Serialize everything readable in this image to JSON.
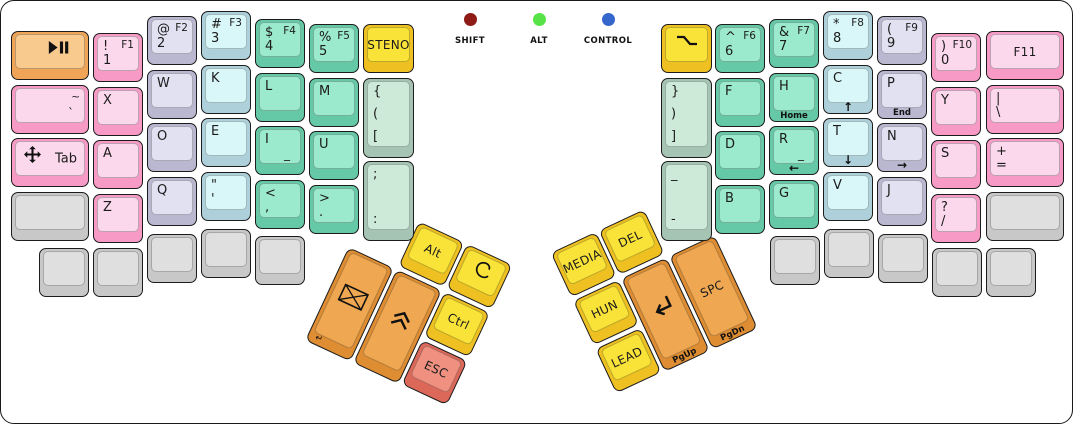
{
  "indicators": [
    {
      "id": "shift",
      "label": "SHIFT",
      "color": "#8e1b15"
    },
    {
      "id": "alt",
      "label": "ALT",
      "color": "#57e348"
    },
    {
      "id": "control",
      "label": "CONTROL",
      "color": "#3566cc"
    }
  ],
  "palette": {
    "orangeLight": {
      "side": "#f0a458",
      "top": "#f9ca8e"
    },
    "orange": {
      "side": "#de8d33",
      "top": "#efa851"
    },
    "pink": {
      "side": "#f79ac5",
      "top": "#fbd8ec"
    },
    "lavender": {
      "side": "#bab8d0",
      "top": "#e2e1f2"
    },
    "blue": {
      "side": "#aed0da",
      "top": "#d9f7f9"
    },
    "teal": {
      "side": "#65c8a6",
      "top": "#9ceacd"
    },
    "sage": {
      "side": "#a6c4b3",
      "top": "#cdead9"
    },
    "yellow": {
      "side": "#eec021",
      "top": "#fae339"
    },
    "red": {
      "side": "#dc685a",
      "top": "#ef9080"
    },
    "gray": {
      "side": "#c8c8c8",
      "top": "#dfdfdf"
    }
  },
  "keys": [
    {
      "id": "play-pause",
      "x": 10,
      "y": 30,
      "w": 78,
      "fam": "orangeLight",
      "icon": "play-pause",
      "iconPos": "right"
    },
    {
      "id": "grave",
      "x": 10,
      "y": 84,
      "w": 78,
      "fam": "pink",
      "legends": {
        "tr": "~",
        "br": "`"
      }
    },
    {
      "id": "tab",
      "x": 10,
      "y": 137,
      "w": 78,
      "fam": "pink",
      "icon": "move",
      "iconPos": "left",
      "legends": {
        "cr": "Tab"
      }
    },
    {
      "id": "blank-left-row4",
      "x": 10,
      "y": 191,
      "w": 78,
      "fam": "gray"
    },
    {
      "id": "1",
      "x": 92,
      "y": 32,
      "fam": "pink",
      "legends": {
        "tl": "!",
        "tr": "F1",
        "bl": "1"
      }
    },
    {
      "id": "x",
      "x": 92,
      "y": 86,
      "fam": "pink",
      "legends": {
        "tl": "X"
      }
    },
    {
      "id": "a",
      "x": 92,
      "y": 139,
      "fam": "pink",
      "legends": {
        "tl": "A"
      }
    },
    {
      "id": "z",
      "x": 92,
      "y": 193,
      "fam": "pink",
      "legends": {
        "tl": "Z"
      }
    },
    {
      "id": "2",
      "x": 146,
      "y": 15,
      "fam": "lavender",
      "legends": {
        "tl": "@",
        "tr": "F2",
        "bl": "2"
      }
    },
    {
      "id": "w",
      "x": 146,
      "y": 69,
      "fam": "lavender",
      "legends": {
        "tl": "W"
      }
    },
    {
      "id": "o",
      "x": 146,
      "y": 122,
      "fam": "lavender",
      "legends": {
        "tl": "O"
      }
    },
    {
      "id": "q",
      "x": 146,
      "y": 176,
      "fam": "lavender",
      "legends": {
        "tl": "Q"
      }
    },
    {
      "id": "3",
      "x": 200,
      "y": 10,
      "fam": "blue",
      "legends": {
        "tl": "#",
        "tr": "F3",
        "bl": "3"
      }
    },
    {
      "id": "k",
      "x": 200,
      "y": 64,
      "fam": "blue",
      "legends": {
        "tl": "K"
      }
    },
    {
      "id": "e",
      "x": 200,
      "y": 117,
      "fam": "blue",
      "legends": {
        "tl": "E"
      }
    },
    {
      "id": "quote",
      "x": 200,
      "y": 171,
      "fam": "blue",
      "legends": {
        "tl": "\"",
        "bl": "'"
      }
    },
    {
      "id": "4",
      "x": 254,
      "y": 18,
      "fam": "teal",
      "legends": {
        "tl": "$",
        "tr": "F4",
        "bl": "4"
      }
    },
    {
      "id": "l",
      "x": 254,
      "y": 72,
      "fam": "teal",
      "legends": {
        "tl": "L"
      }
    },
    {
      "id": "i",
      "x": 254,
      "y": 125,
      "fam": "teal",
      "legends": {
        "tl": "I",
        "br": "_"
      }
    },
    {
      "id": "comma",
      "x": 254,
      "y": 179,
      "fam": "teal",
      "legends": {
        "tl": "<",
        "bl": ","
      }
    },
    {
      "id": "5",
      "x": 308,
      "y": 23,
      "fam": "teal",
      "legends": {
        "tl": "%",
        "tr": "F5",
        "bl": "5"
      }
    },
    {
      "id": "m",
      "x": 308,
      "y": 77,
      "fam": "teal",
      "legends": {
        "tl": "M"
      }
    },
    {
      "id": "u",
      "x": 308,
      "y": 130,
      "fam": "teal",
      "legends": {
        "tl": "U"
      }
    },
    {
      "id": "period",
      "x": 308,
      "y": 184,
      "fam": "teal",
      "legends": {
        "tl": ">",
        "bl": "."
      }
    },
    {
      "id": "steno",
      "x": 362,
      "y": 23,
      "w": 51,
      "fam": "yellow",
      "legends": {
        "c": "STENO"
      }
    },
    {
      "id": "open-brackets",
      "x": 362,
      "y": 77,
      "w": 51,
      "h": 80,
      "fam": "sage",
      "legends": {
        "tl": "{",
        "cl": "(",
        "bl": "["
      }
    },
    {
      "id": "semicolon",
      "x": 362,
      "y": 160,
      "w": 51,
      "h": 80,
      "fam": "sage",
      "legends": {
        "tl": ";",
        "bl": ":"
      }
    },
    {
      "id": "blank-left-b1",
      "x": 38,
      "y": 247,
      "fam": "gray"
    },
    {
      "id": "blank-left-b2",
      "x": 92,
      "y": 247,
      "fam": "gray"
    },
    {
      "id": "blank-left-b3",
      "x": 146,
      "y": 233,
      "fam": "gray"
    },
    {
      "id": "blank-left-b4",
      "x": 200,
      "y": 228,
      "fam": "gray"
    },
    {
      "id": "blank-left-b5",
      "x": 254,
      "y": 235,
      "fam": "gray"
    },
    {
      "id": "layer",
      "x": 660,
      "y": 23,
      "w": 51,
      "fam": "yellow",
      "icon": "signal"
    },
    {
      "id": "close-brackets",
      "x": 660,
      "y": 77,
      "w": 51,
      "h": 80,
      "fam": "sage",
      "legends": {
        "tl": "}",
        "cl": ")",
        "bl": "]"
      }
    },
    {
      "id": "minus",
      "x": 660,
      "y": 160,
      "w": 51,
      "h": 80,
      "fam": "sage",
      "legends": {
        "tl": "_",
        "bl": "-"
      }
    },
    {
      "id": "6",
      "x": 714,
      "y": 23,
      "fam": "teal",
      "legends": {
        "tl": "^",
        "tr": "F6",
        "bl": "6"
      }
    },
    {
      "id": "f",
      "x": 714,
      "y": 77,
      "fam": "teal",
      "legends": {
        "tl": "F"
      }
    },
    {
      "id": "d",
      "x": 714,
      "y": 130,
      "fam": "teal",
      "legends": {
        "tl": "D"
      }
    },
    {
      "id": "b",
      "x": 714,
      "y": 184,
      "fam": "teal",
      "legends": {
        "tl": "B"
      }
    },
    {
      "id": "7",
      "x": 768,
      "y": 18,
      "fam": "teal",
      "legends": {
        "tl": "&",
        "tr": "F7",
        "bl": "7"
      }
    },
    {
      "id": "h",
      "x": 768,
      "y": 72,
      "fam": "teal",
      "legends": {
        "tl": "H"
      },
      "front": "Home"
    },
    {
      "id": "r",
      "x": 768,
      "y": 125,
      "fam": "teal",
      "legends": {
        "tl": "R",
        "br": "_"
      },
      "front": "←"
    },
    {
      "id": "g",
      "x": 768,
      "y": 179,
      "fam": "teal",
      "legends": {
        "tl": "G"
      }
    },
    {
      "id": "8",
      "x": 822,
      "y": 10,
      "fam": "blue",
      "legends": {
        "tl": "*",
        "tr": "F8",
        "bl": "8"
      }
    },
    {
      "id": "c",
      "x": 822,
      "y": 64,
      "fam": "blue",
      "legends": {
        "tl": "C"
      },
      "front": "↑"
    },
    {
      "id": "t",
      "x": 822,
      "y": 117,
      "fam": "blue",
      "legends": {
        "tl": "T"
      },
      "front": "↓"
    },
    {
      "id": "v",
      "x": 822,
      "y": 171,
      "fam": "blue",
      "legends": {
        "tl": "V"
      }
    },
    {
      "id": "9",
      "x": 876,
      "y": 15,
      "fam": "lavender",
      "legends": {
        "tl": "(",
        "tr": "F9",
        "bl": "9"
      }
    },
    {
      "id": "p",
      "x": 876,
      "y": 69,
      "fam": "lavender",
      "legends": {
        "tl": "P"
      },
      "front": "End"
    },
    {
      "id": "n",
      "x": 876,
      "y": 122,
      "fam": "lavender",
      "legends": {
        "tl": "N"
      },
      "front": "→"
    },
    {
      "id": "j",
      "x": 876,
      "y": 176,
      "fam": "lavender",
      "legends": {
        "tl": "J"
      }
    },
    {
      "id": "0",
      "x": 930,
      "y": 32,
      "fam": "pink",
      "legends": {
        "tl": ")",
        "tr": "F10",
        "bl": "0"
      }
    },
    {
      "id": "y",
      "x": 930,
      "y": 86,
      "fam": "pink",
      "legends": {
        "tl": "Y"
      }
    },
    {
      "id": "s",
      "x": 930,
      "y": 139,
      "fam": "pink",
      "legends": {
        "tl": "S"
      }
    },
    {
      "id": "slash",
      "x": 930,
      "y": 193,
      "fam": "pink",
      "legends": {
        "tl": "?",
        "bl": "/"
      }
    },
    {
      "id": "f11",
      "x": 985,
      "y": 30,
      "w": 78,
      "fam": "pink",
      "legends": {
        "c": "F11"
      }
    },
    {
      "id": "backslash",
      "x": 985,
      "y": 84,
      "w": 78,
      "fam": "pink",
      "legends": {
        "tl": "|",
        "bl": "\\"
      }
    },
    {
      "id": "equals",
      "x": 985,
      "y": 137,
      "w": 78,
      "fam": "pink",
      "legends": {
        "tl": "+",
        "bl": "="
      }
    },
    {
      "id": "blank-right-row4",
      "x": 985,
      "y": 191,
      "w": 78,
      "fam": "gray"
    },
    {
      "id": "blank-right-b1",
      "x": 769,
      "y": 235,
      "fam": "gray"
    },
    {
      "id": "blank-right-b2",
      "x": 823,
      "y": 228,
      "fam": "gray"
    },
    {
      "id": "blank-right-b3",
      "x": 877,
      "y": 233,
      "fam": "gray"
    },
    {
      "id": "blank-right-b4",
      "x": 931,
      "y": 247,
      "fam": "gray"
    },
    {
      "id": "blank-right-b5",
      "x": 985,
      "y": 247,
      "fam": "gray"
    },
    {
      "id": "alt",
      "cluster": "left",
      "x": 53,
      "y": 0,
      "fam": "yellow",
      "legends": {
        "c": "Alt"
      }
    },
    {
      "id": "super",
      "cluster": "left",
      "x": 106,
      "y": 0,
      "fam": "yellow",
      "icon": "spiral"
    },
    {
      "id": "send",
      "cluster": "left",
      "x": 0,
      "y": 53,
      "h": 103,
      "fam": "orange",
      "icon": "envelope",
      "front": "↵",
      "frontAlign": "left"
    },
    {
      "id": "shift-up",
      "cluster": "left",
      "x": 53,
      "y": 53,
      "h": 103,
      "fam": "orange",
      "icon": "chevrons-up"
    },
    {
      "id": "ctrl",
      "cluster": "left",
      "x": 106,
      "y": 53,
      "fam": "yellow",
      "legends": {
        "c": "Ctrl"
      }
    },
    {
      "id": "esc",
      "cluster": "left",
      "x": 106,
      "y": 106,
      "fam": "red",
      "legends": {
        "c": "ESC"
      }
    },
    {
      "id": "media",
      "cluster": "right",
      "x": 0,
      "y": 0,
      "fam": "yellow",
      "legends": {
        "c": "MEDIA"
      }
    },
    {
      "id": "del",
      "cluster": "right",
      "x": 53,
      "y": 0,
      "fam": "yellow",
      "legends": {
        "c": "DEL"
      }
    },
    {
      "id": "hun",
      "cluster": "right",
      "x": 0,
      "y": 53,
      "fam": "yellow",
      "legends": {
        "c": "HUN"
      }
    },
    {
      "id": "lead",
      "cluster": "right",
      "x": 0,
      "y": 106,
      "fam": "yellow",
      "legends": {
        "c": "LEAD"
      }
    },
    {
      "id": "enter",
      "cluster": "right",
      "x": 53,
      "y": 53,
      "h": 103,
      "fam": "orange",
      "icon": "return",
      "front": "PgUp"
    },
    {
      "id": "space",
      "cluster": "right",
      "x": 106,
      "y": 53,
      "h": 103,
      "fam": "orange",
      "legends": {
        "c": "SPC"
      },
      "front": "PgDn"
    }
  ]
}
